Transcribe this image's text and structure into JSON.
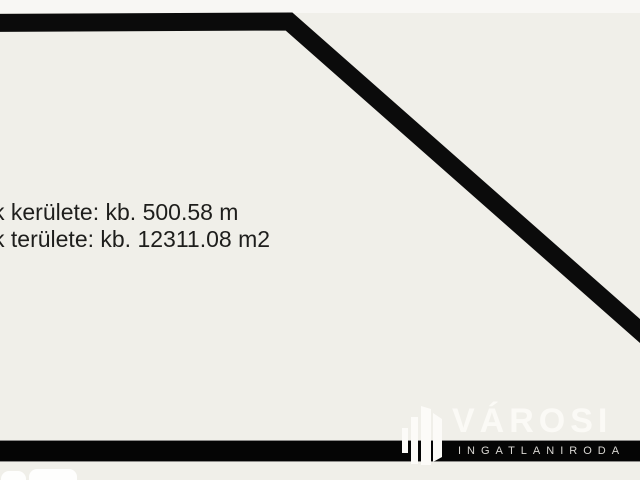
{
  "measurements": {
    "perimeter_line": "k kerülete: kb. 500.58 m",
    "area_line": "k területe: kb. 12311.08 m2"
  },
  "logo": {
    "brand": "VÁROSI",
    "subtitle": "INGATLANIRODA",
    "icon": "buildings-icon"
  },
  "colors": {
    "background": "#f0efe9",
    "top_strip": "#f8f7f4",
    "outline": "#0b0b0b",
    "text": "#1e1e1c",
    "logo_bar": "#050505",
    "logo_bar_edge": "#8c8b89",
    "brand_text": "#fbfaf6",
    "subtitle_text": "#d9d7d3",
    "logo_icon": "#fcfbf8",
    "corner_shapes": "#fefefd"
  }
}
